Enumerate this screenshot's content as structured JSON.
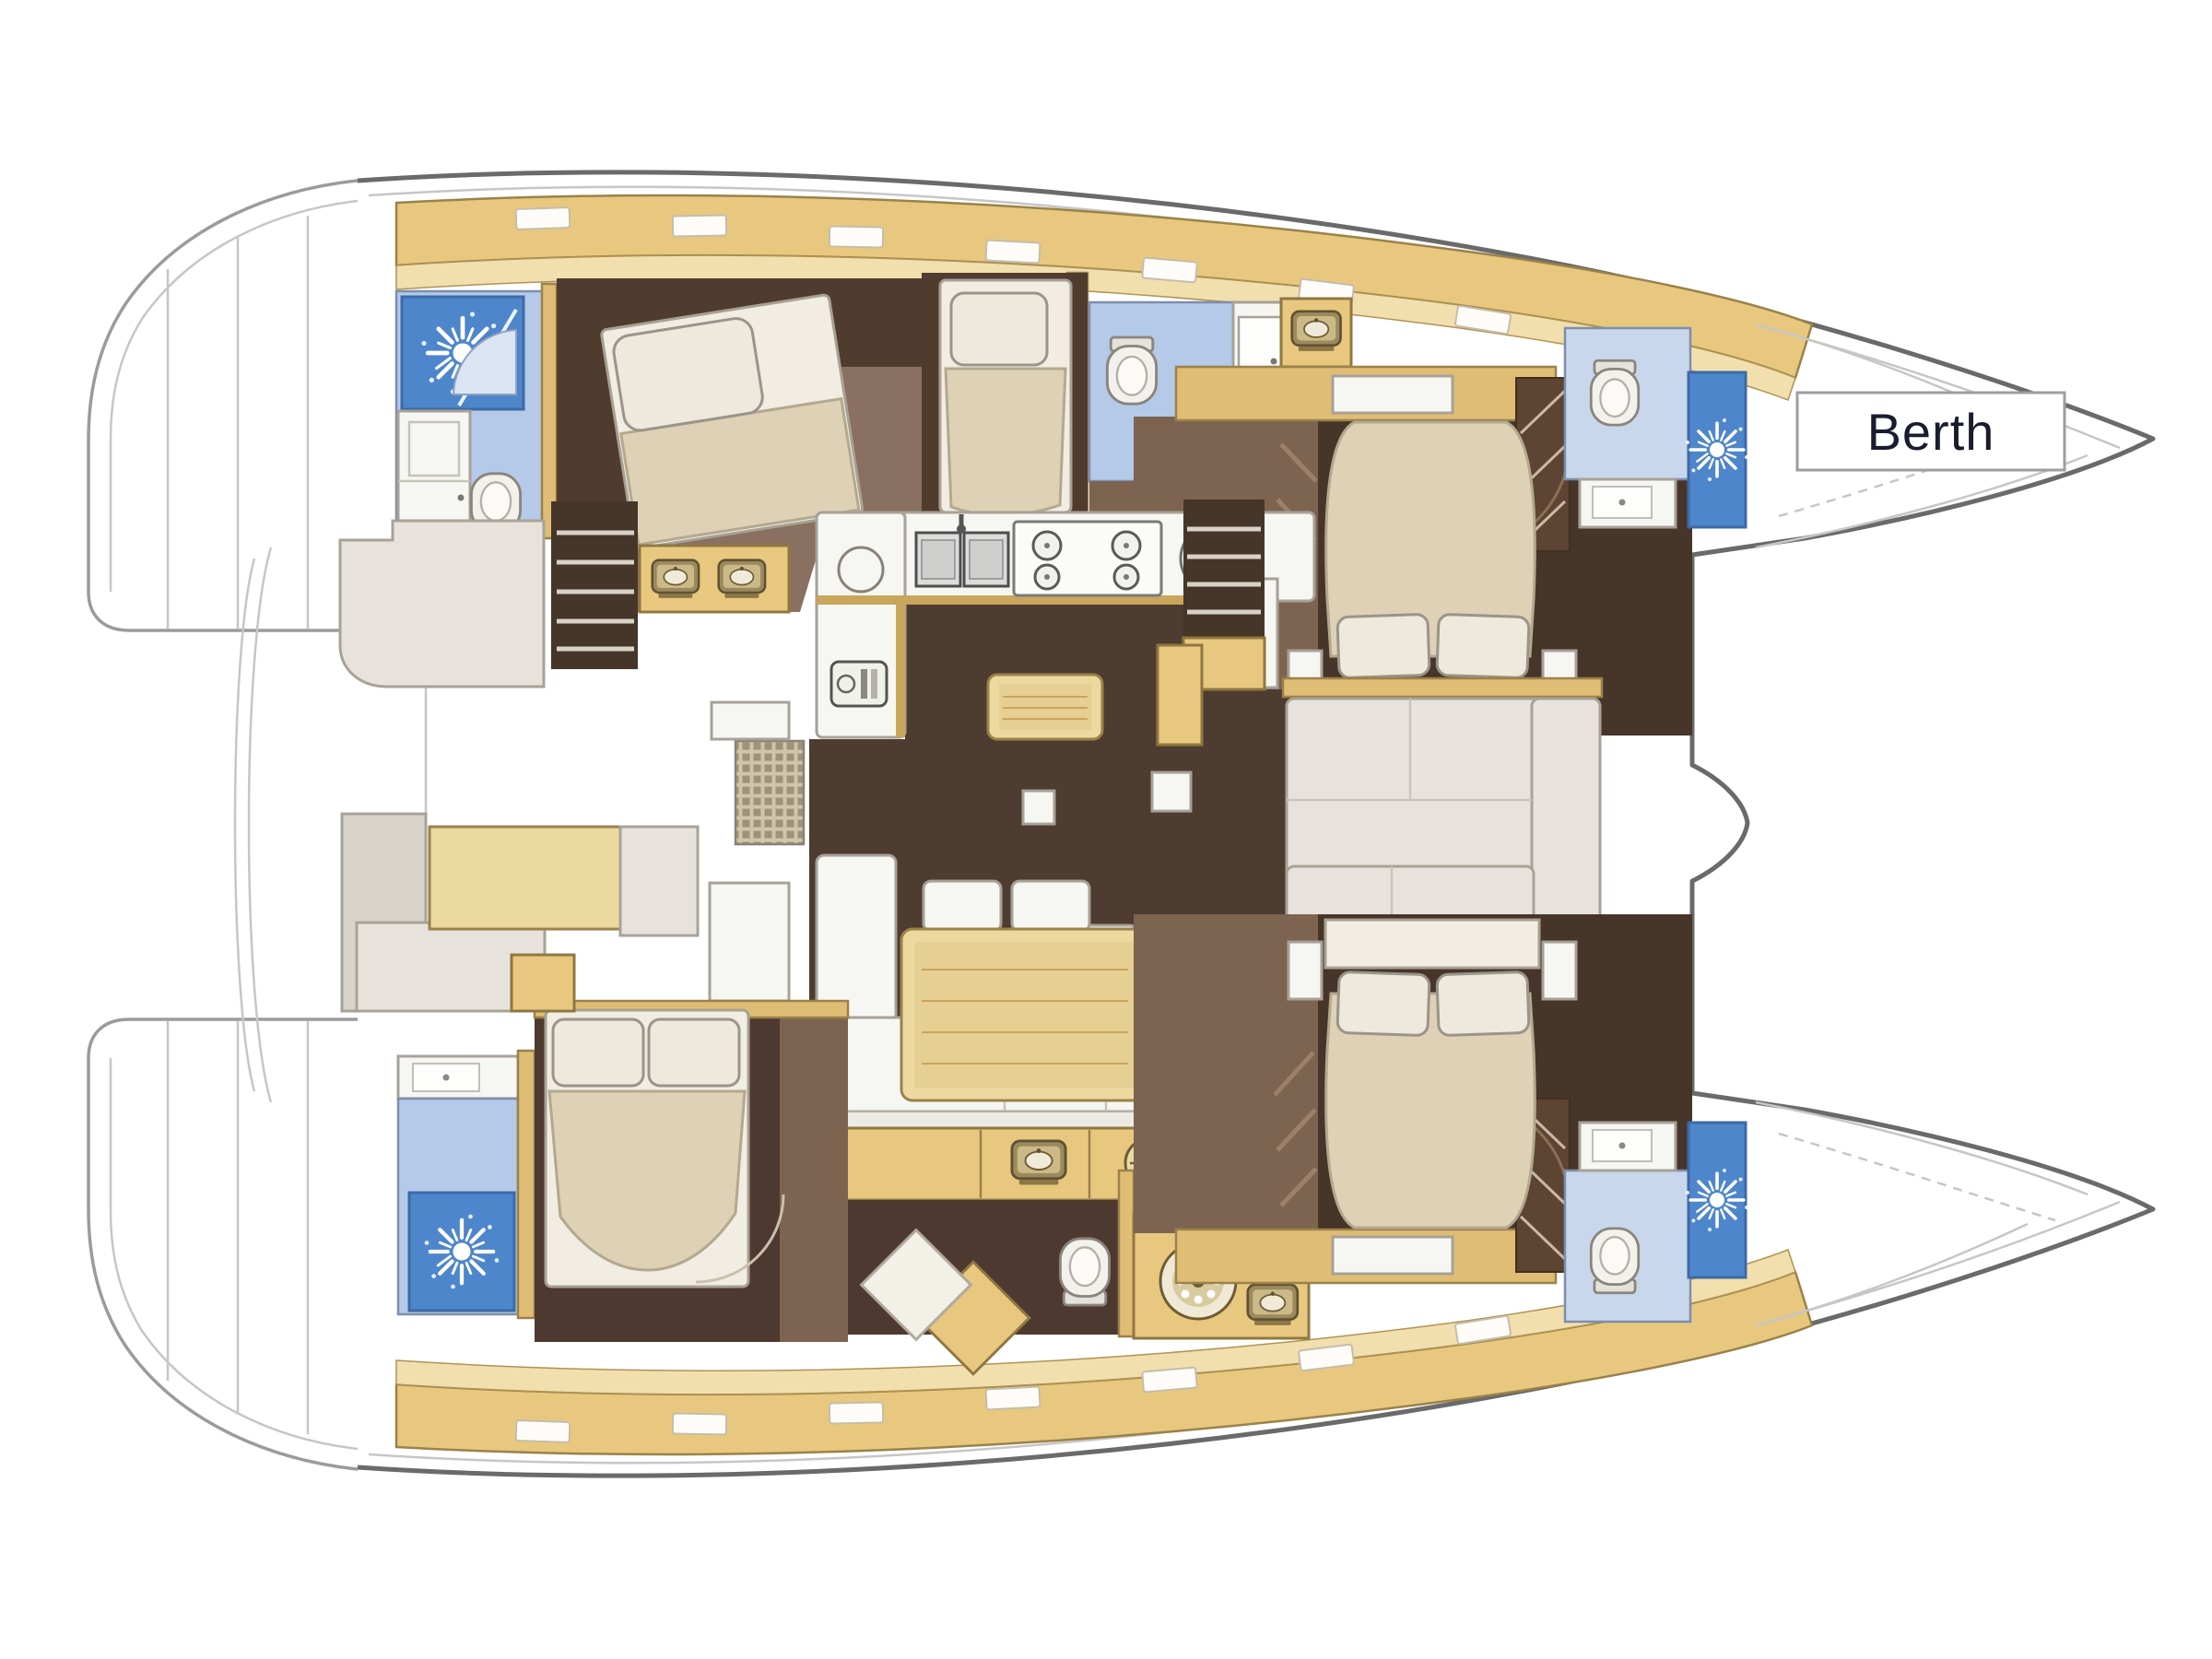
{
  "document": {
    "type": "yacht-floorplan",
    "subject": "catamaran interior layout plan view",
    "background": "#ffffff"
  },
  "annotations": {
    "berth": {
      "text": "Berth",
      "text_color": "#181c2e",
      "box_fill": "#ffffff",
      "box_border": "#9e9e9e"
    }
  },
  "palette": {
    "hull_outline": "#6a6a6a",
    "faint_linework": "#c6c6c6",
    "cabinet_tan": "#e8c87f",
    "cabinet_tan_light": "#f2dfae",
    "wall_tan": "#caa55c",
    "floor_dark_brown": "#4e3c30",
    "floor_cabin_brown": "#7d6450",
    "floor_cabin_dark": "#47352a",
    "shower_blue": "#4e86cb",
    "bathroom_blue": "#b5c9e8",
    "bathroom_blue_light": "#c9d7ec",
    "bed_beige": "#ded1b5",
    "bed_frame_white": "#f1ede2",
    "pillow": "#eee9dc",
    "seat_gray": "#e7e3dc",
    "table_tan": "#ecd9a0",
    "counter_white": "#f6f6f2",
    "steps_dark": "#46362a"
  },
  "icons": {
    "shower_spray": "sun-spray-icon",
    "toilet": "toilet-icon",
    "sink": "sink-icon",
    "stove": "four-burner-stove-icon",
    "round_hob": "round-hob-icon",
    "washer": "washing-machine-icon",
    "helm_wheel": "wheel-icon",
    "appliance": "dishwasher-icon",
    "grate": "floor-grate"
  }
}
